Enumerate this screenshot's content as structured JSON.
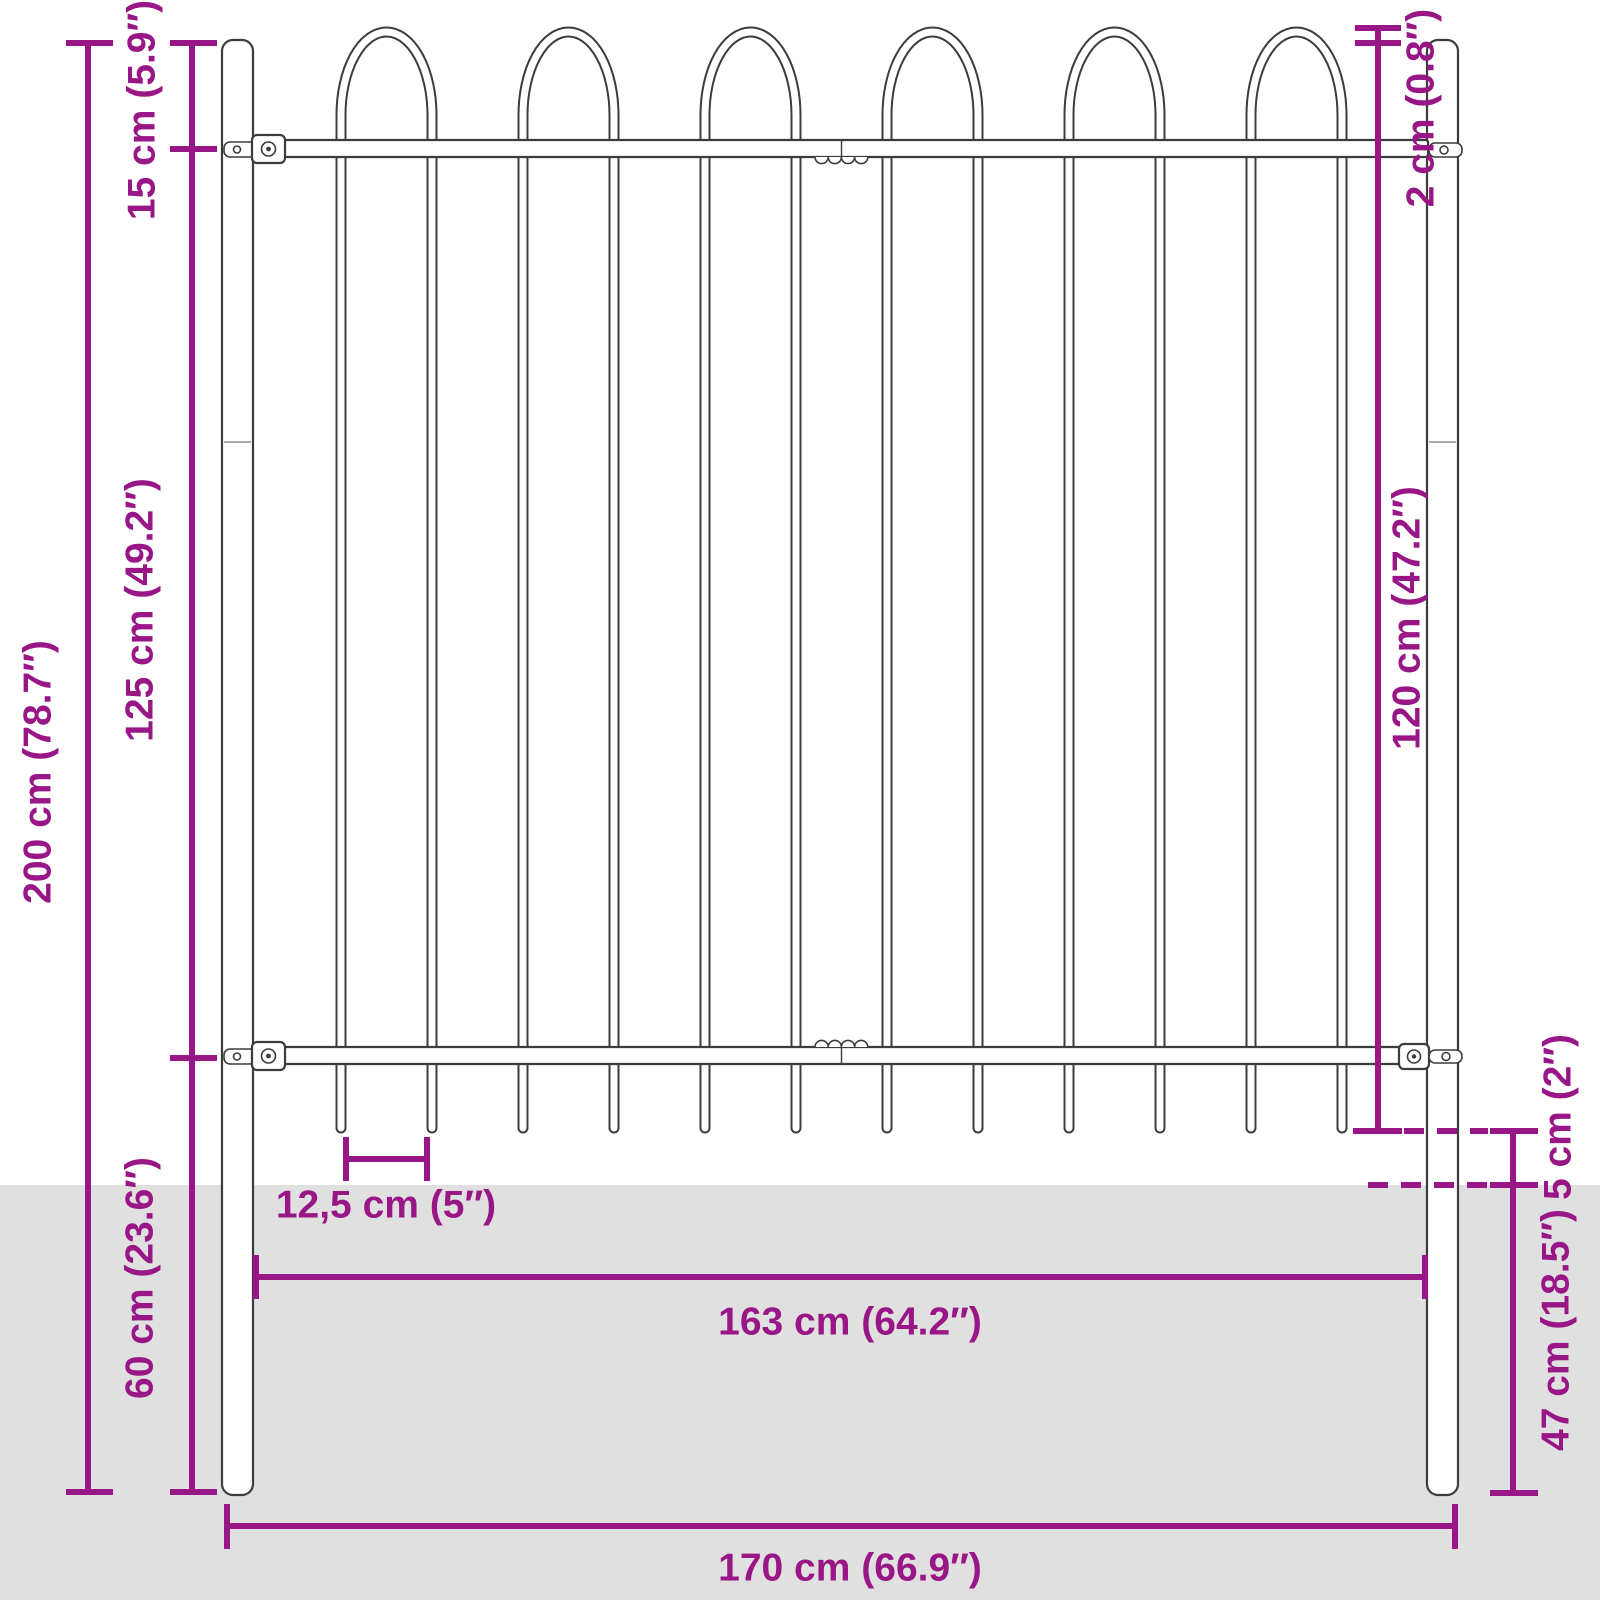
{
  "colors": {
    "accent": "#981685",
    "outline": "#3c3c3c",
    "ground": "#e0e0e0",
    "bg": "#ffffff"
  },
  "diagram": {
    "subject": "steel fence panel with hoop top and posts, dimension drawing",
    "labels": {
      "total_height": "200 cm (78.7″)",
      "top_section": "15 cm (5.9″)",
      "panel_height": "125 cm (49.2″)",
      "below_rail": "60 cm (23.6″)",
      "tube_diameter": "2 cm (0.8″)",
      "bar_length": "120 cm (47.2″)",
      "above_ground_gap": "5 cm (2″)",
      "post_depth": "47 cm (18.5″)",
      "bar_spacing": "12,5 cm (5″)",
      "inner_width": "163 cm (64.2″)",
      "outer_width": "170 cm (66.9″)"
    },
    "structure": {
      "hoop_count": 6,
      "bar_count": 12,
      "post_count": 2,
      "rail_count": 2
    }
  }
}
